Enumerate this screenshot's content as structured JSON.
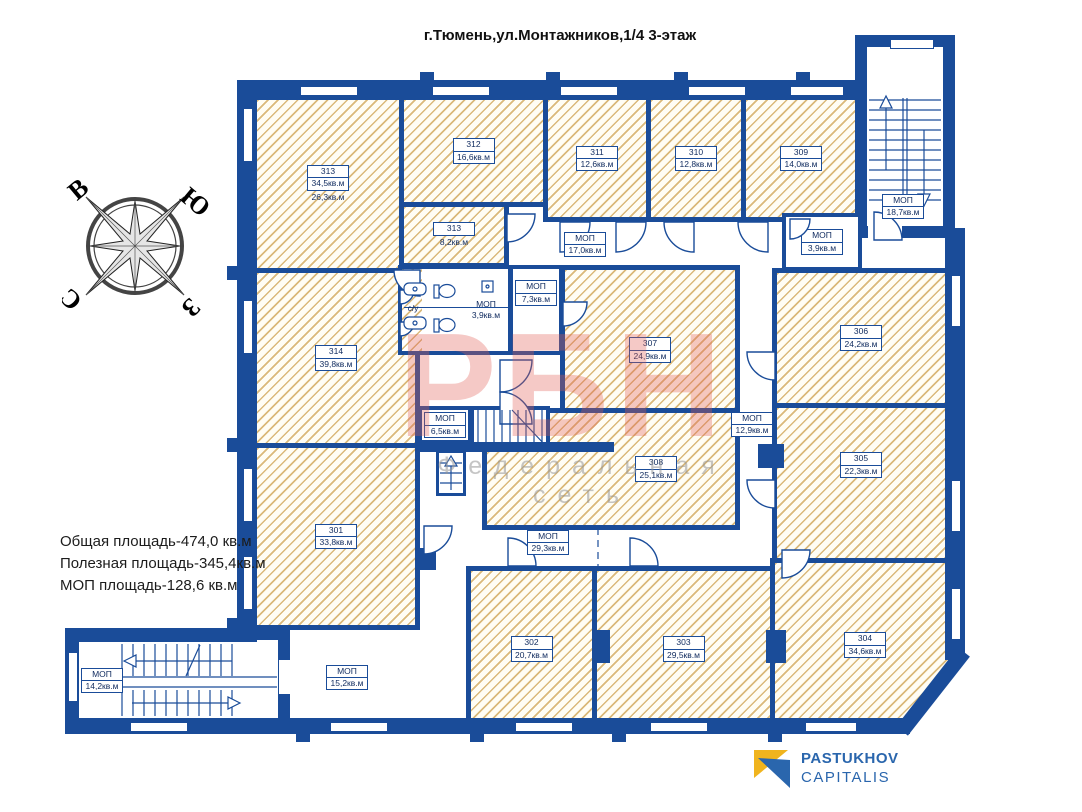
{
  "title": "г.Тюмень,ул.Монтажников,1/4  3-этаж",
  "summary": {
    "line1": "Общая площадь-474,0 кв.м",
    "line2": "Полезная площадь-345,4кв.м",
    "line3": "МОП площадь-128,6 кв.м"
  },
  "compass": {
    "east": "В",
    "south": "Ю",
    "north": "С",
    "west": "З"
  },
  "watermark": {
    "text": "РБН",
    "subtext": "Федеральная сеть"
  },
  "logo": {
    "line1": "PASTUKHOV",
    "line2": "CAPITALIS"
  },
  "rooms": {
    "r313": {
      "number": "313",
      "area": "34,5кв.м",
      "area2": "26,3кв.м"
    },
    "r313b": {
      "number": "313",
      "area": "8,2кв.м"
    },
    "r312": {
      "number": "312",
      "area": "16,6кв.м"
    },
    "r311": {
      "number": "311",
      "area": "12,6кв.м"
    },
    "r310": {
      "number": "310",
      "area": "12,8кв.м"
    },
    "r309": {
      "number": "309",
      "area": "14,0кв.м"
    },
    "r314": {
      "number": "314",
      "area": "39,8кв.м"
    },
    "r301": {
      "number": "301",
      "area": "33,8кв.м"
    },
    "r302": {
      "number": "302",
      "area": "20,7кв.м"
    },
    "r303": {
      "number": "303",
      "area": "29,5кв.м"
    },
    "r304": {
      "number": "304",
      "area": "34,6кв.м"
    },
    "r305": {
      "number": "305",
      "area": "22,3кв.м"
    },
    "r306": {
      "number": "306",
      "area": "24,2кв.м"
    },
    "r307": {
      "number": "307",
      "area": "24,9кв.м"
    },
    "r308": {
      "number": "308",
      "area": "25,1кв.м"
    },
    "mop_stair_ne": {
      "number": "МОП",
      "area": "18,7кв.м"
    },
    "mop_corridor_top": {
      "number": "МОП",
      "area": "17,0кв.м"
    },
    "mop_39_right": {
      "number": "МОП",
      "area": "3,9кв.м"
    },
    "mop_39_wc": {
      "number": "МОП",
      "area": "3,9кв.м"
    },
    "mop_73": {
      "number": "МОП",
      "area": "7,3кв.м"
    },
    "mop_65": {
      "number": "МОП",
      "area": "6,5кв.м"
    },
    "mop_129": {
      "number": "МОП",
      "area": "12,9кв.м"
    },
    "mop_293": {
      "number": "МОП",
      "area": "29,3кв.м"
    },
    "mop_152": {
      "number": "МОП",
      "area": "15,2кв.м"
    },
    "mop_stair_sw": {
      "number": "МОП",
      "area": "14,2кв.м"
    },
    "wc": {
      "label": "с/у"
    }
  },
  "colors": {
    "wall": "#1a4c99",
    "hatch": "#d0a658",
    "watermark_red": "#e25a52",
    "logo_blue": "#2a66ad",
    "logo_yellow": "#f0b41e"
  }
}
